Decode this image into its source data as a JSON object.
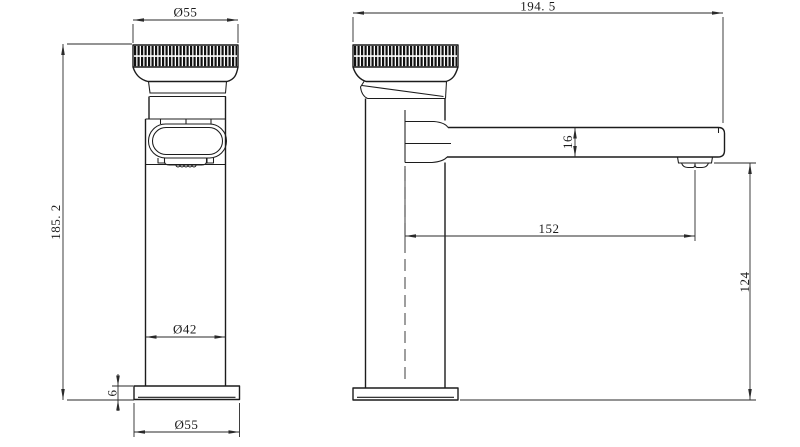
{
  "drawing": {
    "type": "technical-dimension-drawing",
    "subject": "basin faucet two-view drawing",
    "background_color": "#ffffff",
    "line_color": "#1c1c1c",
    "views": {
      "front": {
        "dimensions": {
          "top_knob_diameter": "Ø55",
          "total_height": "185. 2",
          "body_diameter": "Ø42",
          "base_plate_thickness": "6",
          "base_plate_diameter": "Ø55"
        }
      },
      "side": {
        "dimensions": {
          "total_length": "194. 5",
          "spout_section_height": "16",
          "spout_reach": "152",
          "outlet_height": "124"
        }
      }
    }
  }
}
